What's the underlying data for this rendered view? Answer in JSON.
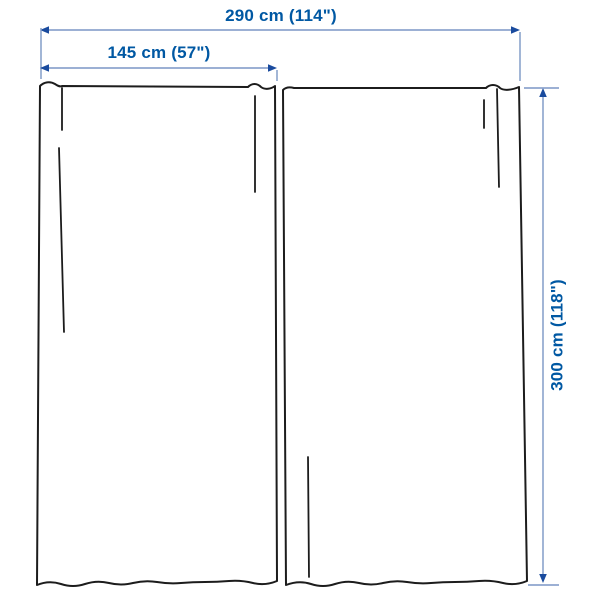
{
  "diagram": {
    "kind": "product-dimension-diagram",
    "depicted_item": "curtains-2-panels",
    "panel_count": 2,
    "dimensions": {
      "total_width_label": "290 cm (114\")",
      "panel_width_label": "145 cm (57\")",
      "height_label": "300 cm (118\")"
    },
    "colors": {
      "label_text": "#0058a3",
      "dimension_line": "#7b96c5",
      "arrowhead": "#1a4b9e",
      "outline": "#1c1c1c",
      "background": "#ffffff"
    }
  }
}
